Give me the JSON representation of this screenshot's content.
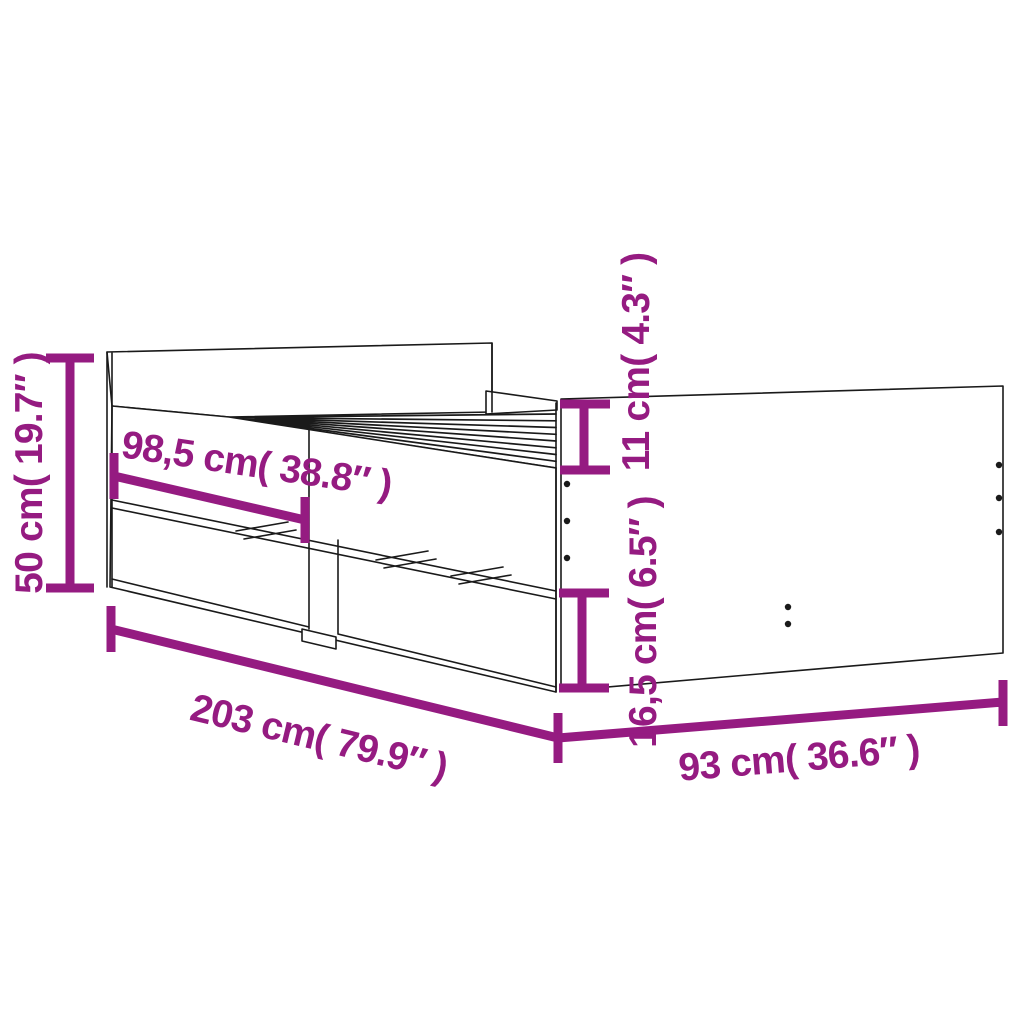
{
  "diagram": {
    "subject": "bed-frame-with-drawers-line-drawing",
    "style": "technical product dimension diagram",
    "colors": {
      "dimension_color": "#951B81",
      "line_art_color": "#1A1A1A",
      "background_color": "#FFFFFF"
    },
    "dimensions": [
      {
        "id": "height",
        "label": "50 cm( 19.7″ )",
        "cm": "50",
        "inch": "19.7",
        "placement": "left-vertical"
      },
      {
        "id": "drawer_section_length",
        "label": "98,5 cm( 38.8″ )",
        "cm": "98,5",
        "inch": "38.8",
        "placement": "side-rail-diagonal"
      },
      {
        "id": "side_rail_height",
        "label": "11 cm( 4.3″ )",
        "cm": "11",
        "inch": "4.3",
        "placement": "foot-end-upper-vertical"
      },
      {
        "id": "drawer_height",
        "label": "16,5 cm( 6.5″ )",
        "cm": "16,5",
        "inch": "6.5",
        "placement": "foot-end-lower-vertical"
      },
      {
        "id": "length",
        "label": "203 cm( 79.9″ )",
        "cm": "203",
        "inch": "79.9",
        "placement": "bottom-left-diagonal"
      },
      {
        "id": "width",
        "label": "93 cm( 36.6″ )",
        "cm": "93",
        "inch": "36.6",
        "placement": "bottom-right-diagonal"
      }
    ]
  }
}
